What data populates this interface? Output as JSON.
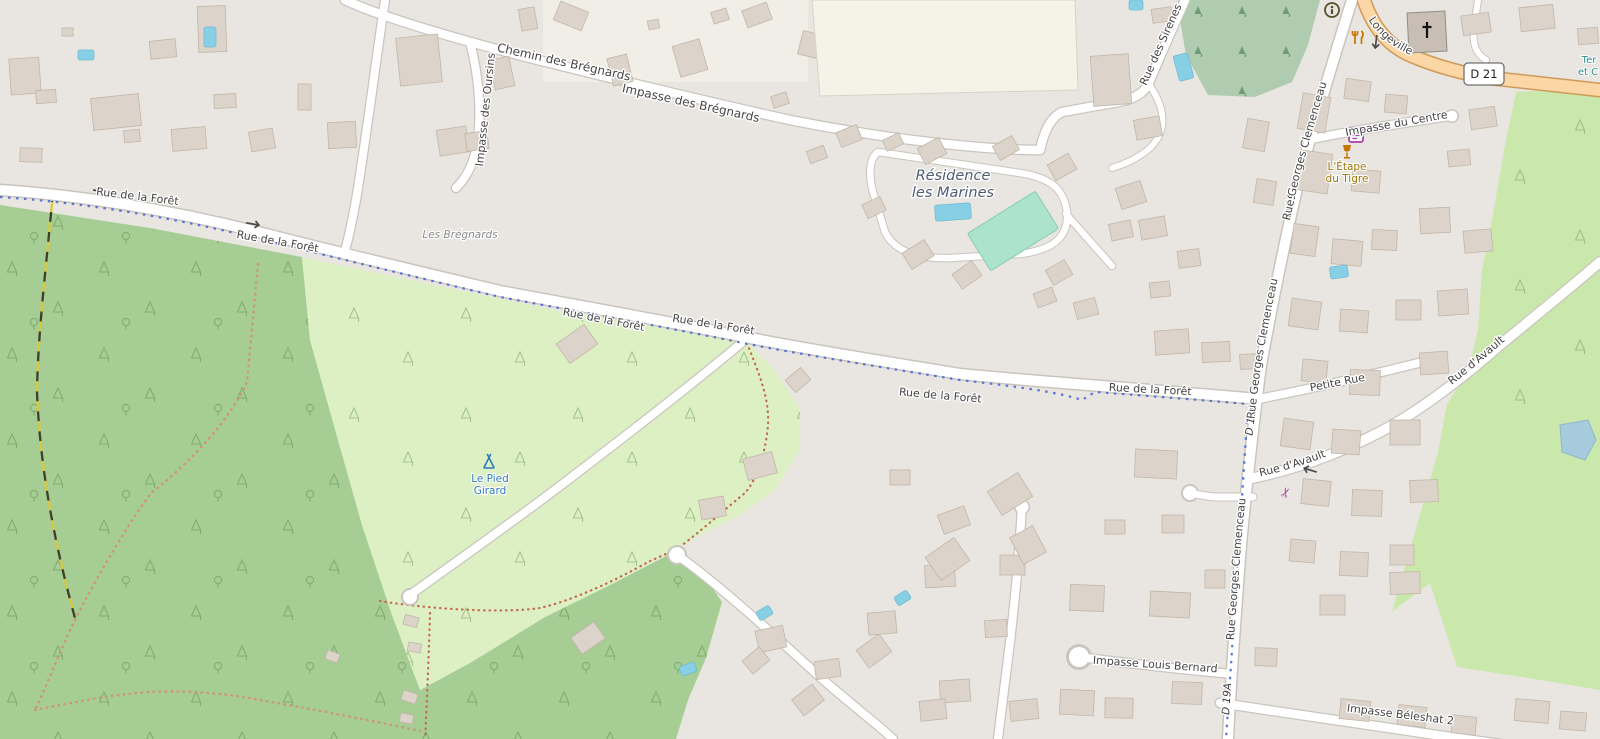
{
  "map": {
    "streets": {
      "chemin_bregnards": "Chemin des Brégnards",
      "impasse_bregnards": "Impasse des Brégnards",
      "impasse_oursins": "Impasse des Oursins",
      "rue_sirenes": "Rue des Sirenes",
      "rue_foret": "Rue de la Forêt",
      "rue_clemenceau": "Rue Georges Clemenceau",
      "route_longeville": "Route de Longeville",
      "impasse_centre": "Impasse du Centre",
      "petite_rue": "Petite Rue",
      "rue_avault": "Rue d'Avault",
      "impasse_louis_bernard": "Impasse Louis Bernard",
      "impasse_beleshat": "Impasse Béleshat 2",
      "ref_d21": "D 21",
      "ref_d19a": "D 19A"
    },
    "places": {
      "les_bregnards": "Les Brégnards",
      "residence_line1": "Résidence",
      "residence_line2": "les Marines",
      "pied_girard_line1": "Le Pied",
      "pied_girard_line2": "Girard",
      "etape_line1": "L'Étape",
      "etape_line2": "du Tigre",
      "leisure_clip_line1": "Ter",
      "leisure_clip_line2": "et C"
    },
    "colors": {
      "forest": "#A6CD93",
      "campsite": "#DDF0C4",
      "meadow": "#CBE8AC",
      "cemetery": "#AFCBB0",
      "pitch": "#ABE3CD",
      "water": "#86CFE4",
      "pond": "#A5CBDC",
      "primary_road": "#FCD6A4",
      "road": "#FFFFFF",
      "building": "#DCD4CA",
      "route_overlay_blue": "#3F5FD7",
      "poi_amber": "#C77400",
      "shop_purple": "#AC39AC",
      "camp_blue": "#2E7CB8"
    }
  }
}
